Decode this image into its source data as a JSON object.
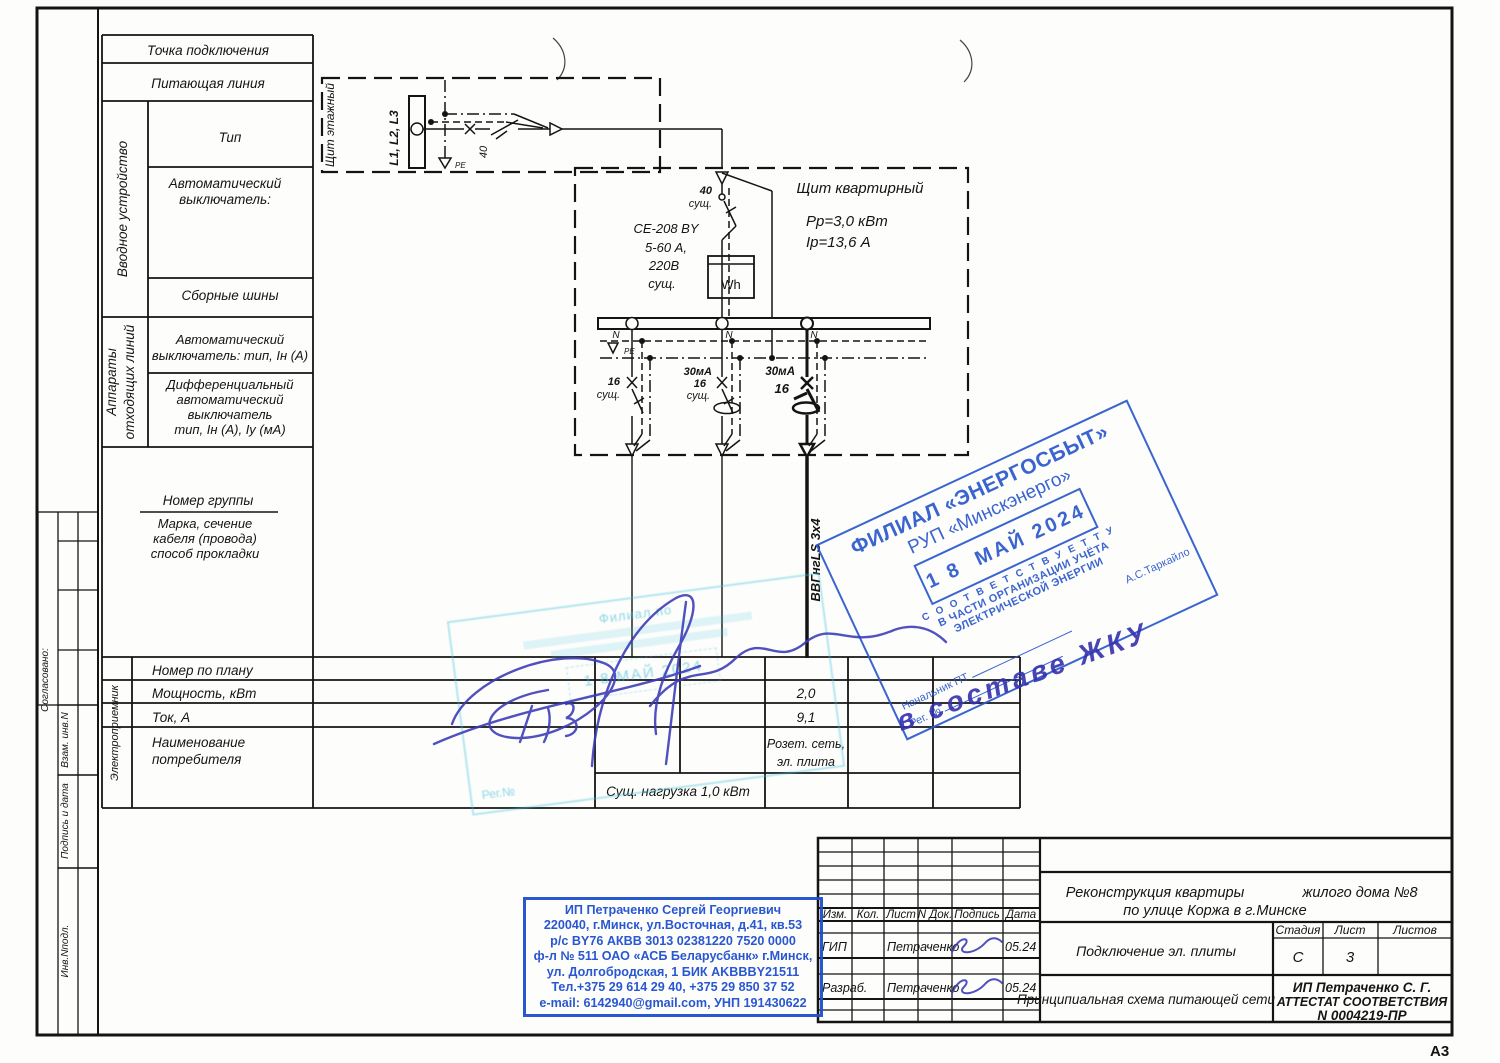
{
  "frame": {
    "format": "А3"
  },
  "margin": {
    "agreed": "Согласовано:",
    "vzam": "Взам. инв.N",
    "podp": "Подпись и дата",
    "inv": "Инв.Nподл."
  },
  "spec": {
    "tochka": "Точка подключения",
    "pitline": "Питающая линия",
    "vvodnoe": "Вводное устройство",
    "tip": "Тип",
    "avt1": "Автоматический",
    "avt2": "выключатель:",
    "shiny": "Сборные шины",
    "app1": "Аппараты",
    "app2": "отходящих линий",
    "out1": "Автоматический",
    "out2": "выключатель: тип, Iн (А)",
    "dif1": "Дифференциальный",
    "dif2": "автоматический",
    "dif3": "выключатель",
    "dif4": "тип, Iн (А), Iу (мА)",
    "group": "Номер группы",
    "marka1": "Марка, сечение",
    "marka2": "кабеля (провода)",
    "marka3": "способ прокладки"
  },
  "scheme": {
    "floor_title": "Щит этажный",
    "bus": "L1, L2, L3",
    "floor_breaker": "40",
    "pe_small": "PE",
    "apt_title": "Щит квартирный",
    "pp": "Рр=3,0 кВт",
    "ip": "Iр=13,6 А",
    "meter1": "СЕ-208 BY",
    "meter2": "5-60 А,",
    "meter3": "220В",
    "meter4": "сущ.",
    "wh": "Wh",
    "in40": "40",
    "in_sush": "сущ.",
    "n": "N",
    "pe": "PE",
    "b1a": "16",
    "b1b": "сущ.",
    "b2a": "30мА",
    "b2b": "16",
    "b2c": "сущ.",
    "b3a": "30мА",
    "b3b": "16",
    "cable": "ВВГнгLS 3х4"
  },
  "load": {
    "receiver": "Электроприемник",
    "r1": "Номер по плану",
    "r2": "Мощность, кВт",
    "v2": "2,0",
    "r3": "Ток, А",
    "v3": "9,1",
    "r4a": "Наименование",
    "r4b": "потребителя",
    "v4a": "Розет. сеть,",
    "v4b": "эл. плита",
    "foot": "Сущ. нагрузка 1,0 кВт"
  },
  "stamps": {
    "blue": {
      "line1": "ФИЛИАЛ «ЭНЕРГОСБЫТ»",
      "line2": "РУП «Минскэнерго»",
      "date": "1 8  МАЙ 2024",
      "line3": "С О О Т В Е Т С Т В У Е Т   Т У",
      "line4": "В ЧАСТИ ОРГАНИЗАЦИИ УЧЁТА",
      "line5": "ЭЛЕКТРИЧЕСКОЙ ЭНЕРГИИ",
      "name": "А.С.Таркайло",
      "chief": "Начальник ПТ",
      "reg": "Рег. №"
    },
    "cyan": {
      "org": "Филиал по",
      "date": "1 8  МАЙ 2024",
      "reg": "Рег.№"
    },
    "hand": "в составе ЖКУ",
    "ip": {
      "l1": "ИП Петраченко Сергей Георгиевич",
      "l2": "220040, г.Минск, ул.Восточная, д.41, кв.53",
      "l3": "р/с BY76 АКВВ 3013 02381220 7520 0000",
      "l4": "ф-л № 511 ОАО «АСБ Беларусбанк» г.Минск,",
      "l5": "ул. Долгобродская, 1  БИК AKBBBY21511",
      "l6": "Тел.+375 29 614 29 40, +375 29 850 37 52",
      "l7": "e-mail: 6142940@gmail.com, УНП 191430622"
    }
  },
  "tb": {
    "cols": [
      "Изм.",
      "Кол.",
      "Лист",
      "N Док.",
      "Подпись",
      "Дата"
    ],
    "rows": [
      {
        "role": "ГИП",
        "name": "Петраченко",
        "date": "05.24"
      },
      {
        "role": "Разраб.",
        "name": "Петраченко",
        "date": "05.24"
      }
    ],
    "project_line1a": "Реконструкция квартиры",
    "project_line1b": "жилого дома №8",
    "project_line2": "по улице Коржа в г.Минске",
    "doc_title": "Подключение эл. плиты",
    "scheme_title": "Принципиальная схема питающей сети",
    "stage_label": "Стадия",
    "stage": "С",
    "sheet_label": "Лист",
    "sheet": "3",
    "sheets_label": "Листов",
    "cert1": "ИП Петраченко С. Г.",
    "cert2": "АТТЕСТАТ СООТВЕТСТВИЯ",
    "cert3": "N 0004219-ПР"
  }
}
